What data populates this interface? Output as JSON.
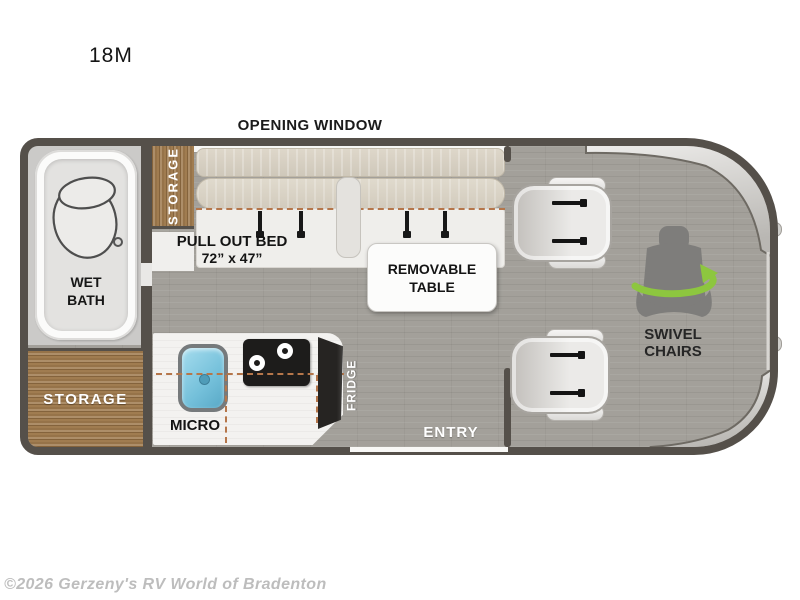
{
  "title": "18M",
  "watermark": "©2026 Gerzeny's RV World of Bradenton",
  "plan": {
    "opening_window": "OPENING WINDOW",
    "wet_bath": {
      "line1": "WET",
      "line2": "BATH"
    },
    "storage_top": "STORAGE",
    "storage_bottom": "STORAGE",
    "bed": {
      "label": "PULL OUT BED",
      "size": "72” x 47”"
    },
    "table": {
      "line1": "REMOVABLE",
      "line2": "TABLE"
    },
    "micro": "MICRO",
    "fridge": "FRIDGE",
    "entry": "ENTRY",
    "swivel": {
      "line1": "SWIVEL",
      "line2": "CHAIRS"
    }
  },
  "colors": {
    "wall": "#55504a",
    "floor": "#a3a09a",
    "wood": "#a07c50",
    "green": "#8dc63f",
    "dash": "#b5764a",
    "sink": "#74c0da"
  }
}
